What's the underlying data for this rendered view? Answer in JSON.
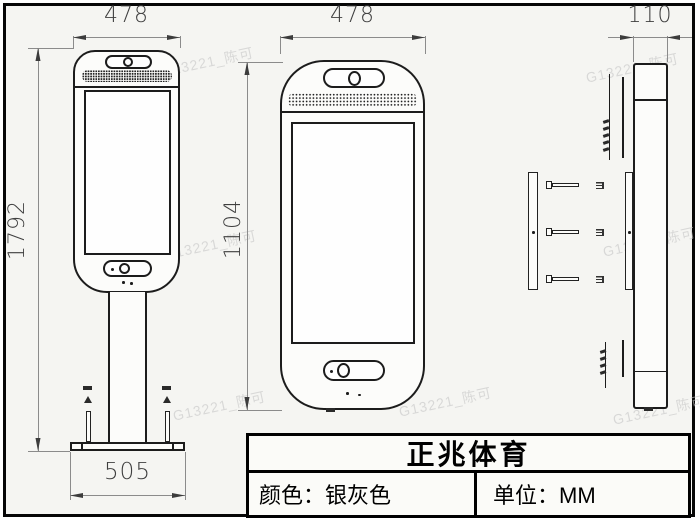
{
  "watermark": {
    "text": "G13221_陈可"
  },
  "views": {
    "front_with_stand": {
      "top_width": "478",
      "overall_height": "1792",
      "base_width": "505"
    },
    "front_head": {
      "width": "478",
      "height": "1104"
    },
    "side": {
      "depth": "110"
    }
  },
  "title_block": {
    "title": "正兆体育",
    "color_label": "颜色：银灰色",
    "unit_label": "单位：MM"
  },
  "colors": {
    "outline": "#1c1c1c",
    "dimension_line": "#8b8b8b",
    "dimension_text": "#3f3f3f",
    "frame": "#060606",
    "background": "#f5f5f2",
    "watermark": "#c6c6c6"
  }
}
